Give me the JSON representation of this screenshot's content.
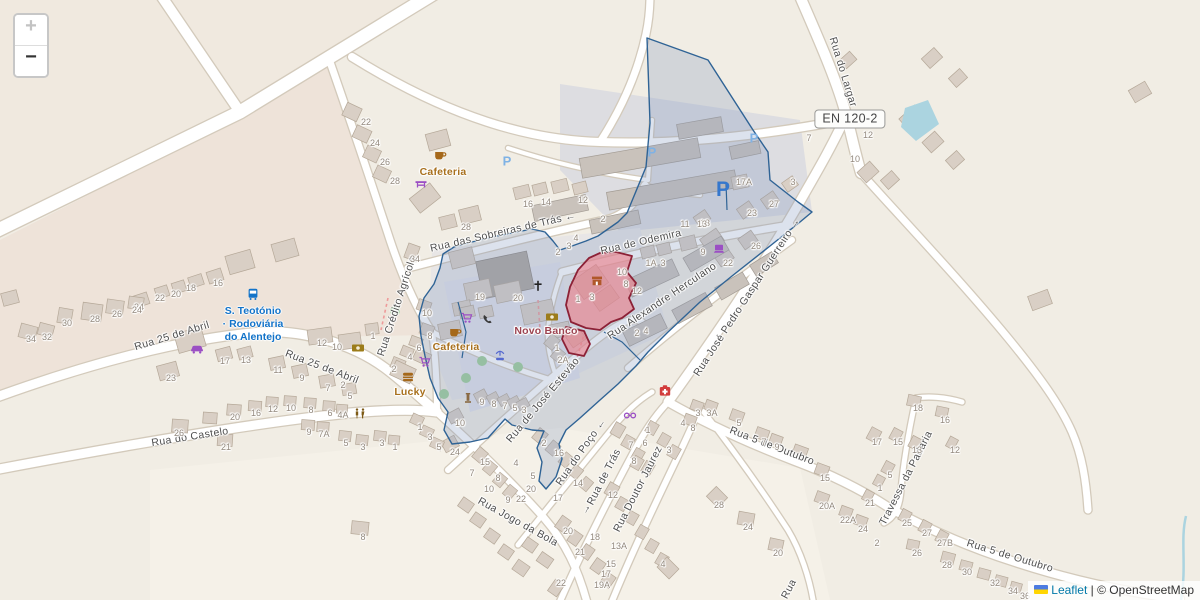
{
  "controls": {
    "zoom_in_label": "+",
    "zoom_out_label": "−"
  },
  "road_badge": {
    "label": "EN 120-2"
  },
  "transit_stop": {
    "line1": "S. Teotónio",
    "line2": "· Rodoviária",
    "line3": "do Alentejo",
    "color": "#1273c9",
    "x": 253,
    "y": 305
  },
  "attribution": {
    "leaflet_label": "Leaflet",
    "separator": " | ",
    "osm_label": "© OpenStreetMap"
  },
  "colors": {
    "land": "#f1ede4",
    "residential": "#eee3d9",
    "industrial": "#dddde1",
    "town_grey": "#e8e6e6",
    "field": "#f5f1e8",
    "plaza": "#e2e2ea",
    "nw_patch": "#f0e9df",
    "building": "#d9cfc5",
    "building_stroke": "#b5a898",
    "warehouse": "#c9c2bb",
    "church": "#aea79f",
    "road": "#ffffff",
    "road_casing": "#d3cabb",
    "water": "#abd4e0",
    "tree": "#9ecf97",
    "blue_stroke": "#2f6395",
    "blue_fill": "rgba(130,152,192,0.28)",
    "red_stroke": "#8c2136",
    "red_fill": "rgba(236,128,138,0.62)",
    "street_label": "#4e4e4e",
    "house_number": "#93897e",
    "amenity_label": "#a8701d",
    "bank_label": "#9c4350",
    "parking_large": "#3577cd",
    "parking_small": "#7fb2e5",
    "path_dashed": "#ee9a9a"
  },
  "street_labels": [
    {
      "text": "Rua do Largar",
      "x": 843,
      "y": 72,
      "rot": 73
    },
    {
      "text": "Rua das Sobreiras de Trás  ←",
      "x": 503,
      "y": 232,
      "rot": -13
    },
    {
      "text": "Rua de Odemira",
      "x": 641,
      "y": 242,
      "rot": -13
    },
    {
      "text": "Rua Alexandre Herculano",
      "x": 662,
      "y": 301,
      "rot": -34
    },
    {
      "text": "Rua José Pedro Gaspar Guerreiro →",
      "x": 747,
      "y": 297,
      "rot": -57
    },
    {
      "text": "Rua 25 de Abril",
      "x": 172,
      "y": 336,
      "rot": -17
    },
    {
      "text": "Rua 25 de Abril",
      "x": 322,
      "y": 367,
      "rot": 21
    },
    {
      "text": "Rua Crédito Agrícola",
      "x": 397,
      "y": 306,
      "rot": -72
    },
    {
      "text": "Rua do Castelo",
      "x": 190,
      "y": 437,
      "rot": -9
    },
    {
      "text": "Rua de José Estevão",
      "x": 543,
      "y": 400,
      "rot": -50
    },
    {
      "text": "Rua do Poço ←",
      "x": 581,
      "y": 452,
      "rot": -55
    },
    {
      "text": "Rua de Trás",
      "x": 604,
      "y": 477,
      "rot": -63
    },
    {
      "text": "→",
      "x": 586,
      "y": 509,
      "rot": -63
    },
    {
      "text": "Rua Doutor Jaurez",
      "x": 638,
      "y": 489,
      "rot": -63
    },
    {
      "text": "Rua Jogo da Bola",
      "x": 518,
      "y": 522,
      "rot": 29
    },
    {
      "text": "Rua 5 de Outubro",
      "x": 772,
      "y": 446,
      "rot": 21
    },
    {
      "text": "Travessa da Padaria",
      "x": 906,
      "y": 478,
      "rot": -63
    },
    {
      "text": "Rua 5 de Outubro",
      "x": 1010,
      "y": 556,
      "rot": 17
    },
    {
      "text": "Rua",
      "x": 789,
      "y": 589,
      "rot": -62
    }
  ],
  "poi_labels": [
    {
      "text": "Cafeteria",
      "x": 443,
      "y": 172,
      "kind": "amenity"
    },
    {
      "text": "Cafeteria",
      "x": 456,
      "y": 347,
      "kind": "amenity"
    },
    {
      "text": "Lucky",
      "x": 410,
      "y": 392,
      "kind": "amenity"
    },
    {
      "text": "Novo Banco",
      "x": 546,
      "y": 331,
      "kind": "bank"
    }
  ],
  "poi_icons": [
    {
      "type": "cafe-icon",
      "x": 440,
      "y": 155
    },
    {
      "type": "picnic-table-icon",
      "x": 421,
      "y": 184
    },
    {
      "type": "cafe-icon",
      "x": 455,
      "y": 332
    },
    {
      "type": "shopping-cart-icon",
      "x": 467,
      "y": 318
    },
    {
      "type": "telephone-icon",
      "x": 488,
      "y": 320
    },
    {
      "type": "bank-icon",
      "x": 552,
      "y": 317
    },
    {
      "type": "bank-icon",
      "x": 358,
      "y": 348
    },
    {
      "type": "fountain-icon",
      "x": 500,
      "y": 356
    },
    {
      "type": "shopping-cart-icon",
      "x": 425,
      "y": 362
    },
    {
      "type": "fast-food-icon",
      "x": 408,
      "y": 377
    },
    {
      "type": "monument-icon",
      "x": 468,
      "y": 399
    },
    {
      "type": "car-shop-icon",
      "x": 197,
      "y": 348
    },
    {
      "type": "bus-stop-icon",
      "x": 253,
      "y": 294
    },
    {
      "type": "laptop-icon",
      "x": 719,
      "y": 249
    },
    {
      "type": "pharmacy-icon",
      "x": 665,
      "y": 391
    },
    {
      "type": "glasses-icon",
      "x": 630,
      "y": 415
    },
    {
      "type": "toilets-icon",
      "x": 360,
      "y": 414
    },
    {
      "type": "department-store-icon",
      "x": 597,
      "y": 281
    },
    {
      "type": "church-cross-icon",
      "x": 538,
      "y": 287
    }
  ],
  "poi_icon_colors": {
    "cafe-icon": "#a5681a",
    "picnic-table-icon": "#9b4fc4",
    "shopping-cart-icon": "#9b4fc4",
    "telephone-icon": "#3a3a3a",
    "bank-icon": "#9c7c1a",
    "fountain-icon": "#5468cf",
    "fast-food-icon": "#a5681a",
    "monument-icon": "#8a6a42",
    "car-shop-icon": "#9b4fc4",
    "bus-stop-icon": "#1273c9",
    "laptop-icon": "#9b4fc4",
    "pharmacy-icon": "#d23c3c",
    "glasses-icon": "#9b4fc4",
    "toilets-icon": "#7d5a16",
    "department-store-icon": "#b0582a",
    "church-cross-icon": "#222222"
  },
  "parking_marks": [
    {
      "x": 507,
      "y": 161,
      "size": "small"
    },
    {
      "x": 652,
      "y": 152,
      "size": "small"
    },
    {
      "x": 754,
      "y": 138,
      "size": "small"
    },
    {
      "x": 723,
      "y": 190,
      "size": "large"
    }
  ],
  "house_numbers": [
    [
      366,
      122,
      "22"
    ],
    [
      375,
      143,
      "24"
    ],
    [
      385,
      162,
      "26"
    ],
    [
      395,
      181,
      "28"
    ],
    [
      466,
      227,
      "28"
    ],
    [
      528,
      204,
      "16"
    ],
    [
      546,
      202,
      "14"
    ],
    [
      583,
      200,
      "12"
    ],
    [
      603,
      219,
      "2"
    ],
    [
      576,
      238,
      "4"
    ],
    [
      569,
      246,
      "3"
    ],
    [
      558,
      252,
      "2"
    ],
    [
      480,
      297,
      "19"
    ],
    [
      518,
      298,
      "20"
    ],
    [
      578,
      299,
      "1"
    ],
    [
      592,
      297,
      "3"
    ],
    [
      622,
      272,
      "10"
    ],
    [
      626,
      284,
      "8"
    ],
    [
      637,
      291,
      "12"
    ],
    [
      651,
      263,
      "1A"
    ],
    [
      663,
      263,
      "3"
    ],
    [
      705,
      223,
      "13"
    ],
    [
      752,
      213,
      "23"
    ],
    [
      774,
      204,
      "27"
    ],
    [
      756,
      246,
      "26"
    ],
    [
      728,
      263,
      "22"
    ],
    [
      703,
      252,
      "9"
    ],
    [
      744,
      182,
      "17A"
    ],
    [
      793,
      182,
      "3"
    ],
    [
      809,
      138,
      "7"
    ],
    [
      868,
      135,
      "12"
    ],
    [
      855,
      159,
      "10"
    ],
    [
      685,
      224,
      "11"
    ],
    [
      702,
      224,
      "13"
    ],
    [
      637,
      333,
      "2"
    ],
    [
      646,
      331,
      "4"
    ],
    [
      415,
      259,
      "34"
    ],
    [
      427,
      313,
      "10"
    ],
    [
      430,
      336,
      "8"
    ],
    [
      419,
      348,
      "6"
    ],
    [
      410,
      357,
      "4"
    ],
    [
      394,
      369,
      "2"
    ],
    [
      218,
      283,
      "16"
    ],
    [
      191,
      288,
      "18"
    ],
    [
      176,
      294,
      "20"
    ],
    [
      160,
      298,
      "22"
    ],
    [
      139,
      307,
      "24"
    ],
    [
      31,
      339,
      "34"
    ],
    [
      47,
      337,
      "32"
    ],
    [
      67,
      323,
      "30"
    ],
    [
      95,
      319,
      "28"
    ],
    [
      117,
      314,
      "26"
    ],
    [
      137,
      310,
      "24"
    ],
    [
      322,
      343,
      "12"
    ],
    [
      337,
      347,
      "10"
    ],
    [
      373,
      336,
      "1"
    ],
    [
      343,
      385,
      "2"
    ],
    [
      171,
      378,
      "23"
    ],
    [
      225,
      361,
      "17"
    ],
    [
      246,
      360,
      "13"
    ],
    [
      278,
      370,
      "11"
    ],
    [
      302,
      378,
      "9"
    ],
    [
      328,
      388,
      "7"
    ],
    [
      350,
      396,
      "5"
    ],
    [
      235,
      417,
      "20"
    ],
    [
      256,
      413,
      "16"
    ],
    [
      273,
      409,
      "12"
    ],
    [
      291,
      408,
      "10"
    ],
    [
      311,
      410,
      "8"
    ],
    [
      330,
      413,
      "6"
    ],
    [
      343,
      415,
      "4A"
    ],
    [
      179,
      433,
      "26"
    ],
    [
      226,
      447,
      "21"
    ],
    [
      309,
      432,
      "9"
    ],
    [
      324,
      434,
      "7A"
    ],
    [
      346,
      443,
      "5"
    ],
    [
      363,
      447,
      "3"
    ],
    [
      382,
      443,
      "3"
    ],
    [
      395,
      447,
      "1"
    ],
    [
      363,
      537,
      "8"
    ],
    [
      482,
      402,
      "9"
    ],
    [
      494,
      404,
      "8"
    ],
    [
      505,
      406,
      "7"
    ],
    [
      515,
      408,
      "5"
    ],
    [
      524,
      410,
      "3"
    ],
    [
      460,
      423,
      "10"
    ],
    [
      455,
      452,
      "24"
    ],
    [
      420,
      427,
      "1"
    ],
    [
      430,
      437,
      "3"
    ],
    [
      439,
      447,
      "5"
    ],
    [
      557,
      348,
      "1"
    ],
    [
      563,
      360,
      "2A"
    ],
    [
      544,
      443,
      "2"
    ],
    [
      559,
      453,
      "16"
    ],
    [
      578,
      483,
      "14"
    ],
    [
      558,
      498,
      "17"
    ],
    [
      533,
      476,
      "5"
    ],
    [
      516,
      463,
      "4"
    ],
    [
      485,
      462,
      "15"
    ],
    [
      472,
      473,
      "7"
    ],
    [
      498,
      478,
      "8"
    ],
    [
      489,
      489,
      "10"
    ],
    [
      508,
      500,
      "9"
    ],
    [
      521,
      499,
      "22"
    ],
    [
      531,
      489,
      "20"
    ],
    [
      613,
      495,
      "12"
    ],
    [
      568,
      531,
      "20"
    ],
    [
      595,
      537,
      "18"
    ],
    [
      619,
      546,
      "13A"
    ],
    [
      580,
      552,
      "21"
    ],
    [
      611,
      564,
      "15"
    ],
    [
      606,
      574,
      "17"
    ],
    [
      602,
      585,
      "19A"
    ],
    [
      561,
      583,
      "22"
    ],
    [
      663,
      564,
      "4"
    ],
    [
      648,
      430,
      "1"
    ],
    [
      645,
      443,
      "6"
    ],
    [
      631,
      445,
      "7"
    ],
    [
      669,
      450,
      "3"
    ],
    [
      634,
      461,
      "8"
    ],
    [
      698,
      413,
      "3"
    ],
    [
      712,
      413,
      "3A"
    ],
    [
      683,
      423,
      "4"
    ],
    [
      693,
      428,
      "8"
    ],
    [
      739,
      423,
      "5"
    ],
    [
      764,
      442,
      "7"
    ],
    [
      777,
      447,
      "9"
    ],
    [
      825,
      478,
      "15"
    ],
    [
      827,
      506,
      "20A"
    ],
    [
      848,
      520,
      "22A"
    ],
    [
      863,
      529,
      "24"
    ],
    [
      719,
      505,
      "28"
    ],
    [
      748,
      527,
      "24"
    ],
    [
      778,
      553,
      "20"
    ],
    [
      877,
      442,
      "17"
    ],
    [
      898,
      442,
      "15"
    ],
    [
      917,
      450,
      "13"
    ],
    [
      890,
      475,
      "5"
    ],
    [
      880,
      488,
      "1"
    ],
    [
      870,
      503,
      "21"
    ],
    [
      907,
      523,
      "25"
    ],
    [
      927,
      533,
      "27"
    ],
    [
      918,
      408,
      "18"
    ],
    [
      945,
      420,
      "16"
    ],
    [
      955,
      450,
      "12"
    ],
    [
      877,
      543,
      "2"
    ],
    [
      917,
      553,
      "26"
    ],
    [
      945,
      543,
      "27B"
    ],
    [
      947,
      565,
      "28"
    ],
    [
      967,
      572,
      "30"
    ],
    [
      995,
      583,
      "32"
    ],
    [
      1013,
      591,
      "34"
    ],
    [
      1025,
      596,
      "36"
    ]
  ]
}
